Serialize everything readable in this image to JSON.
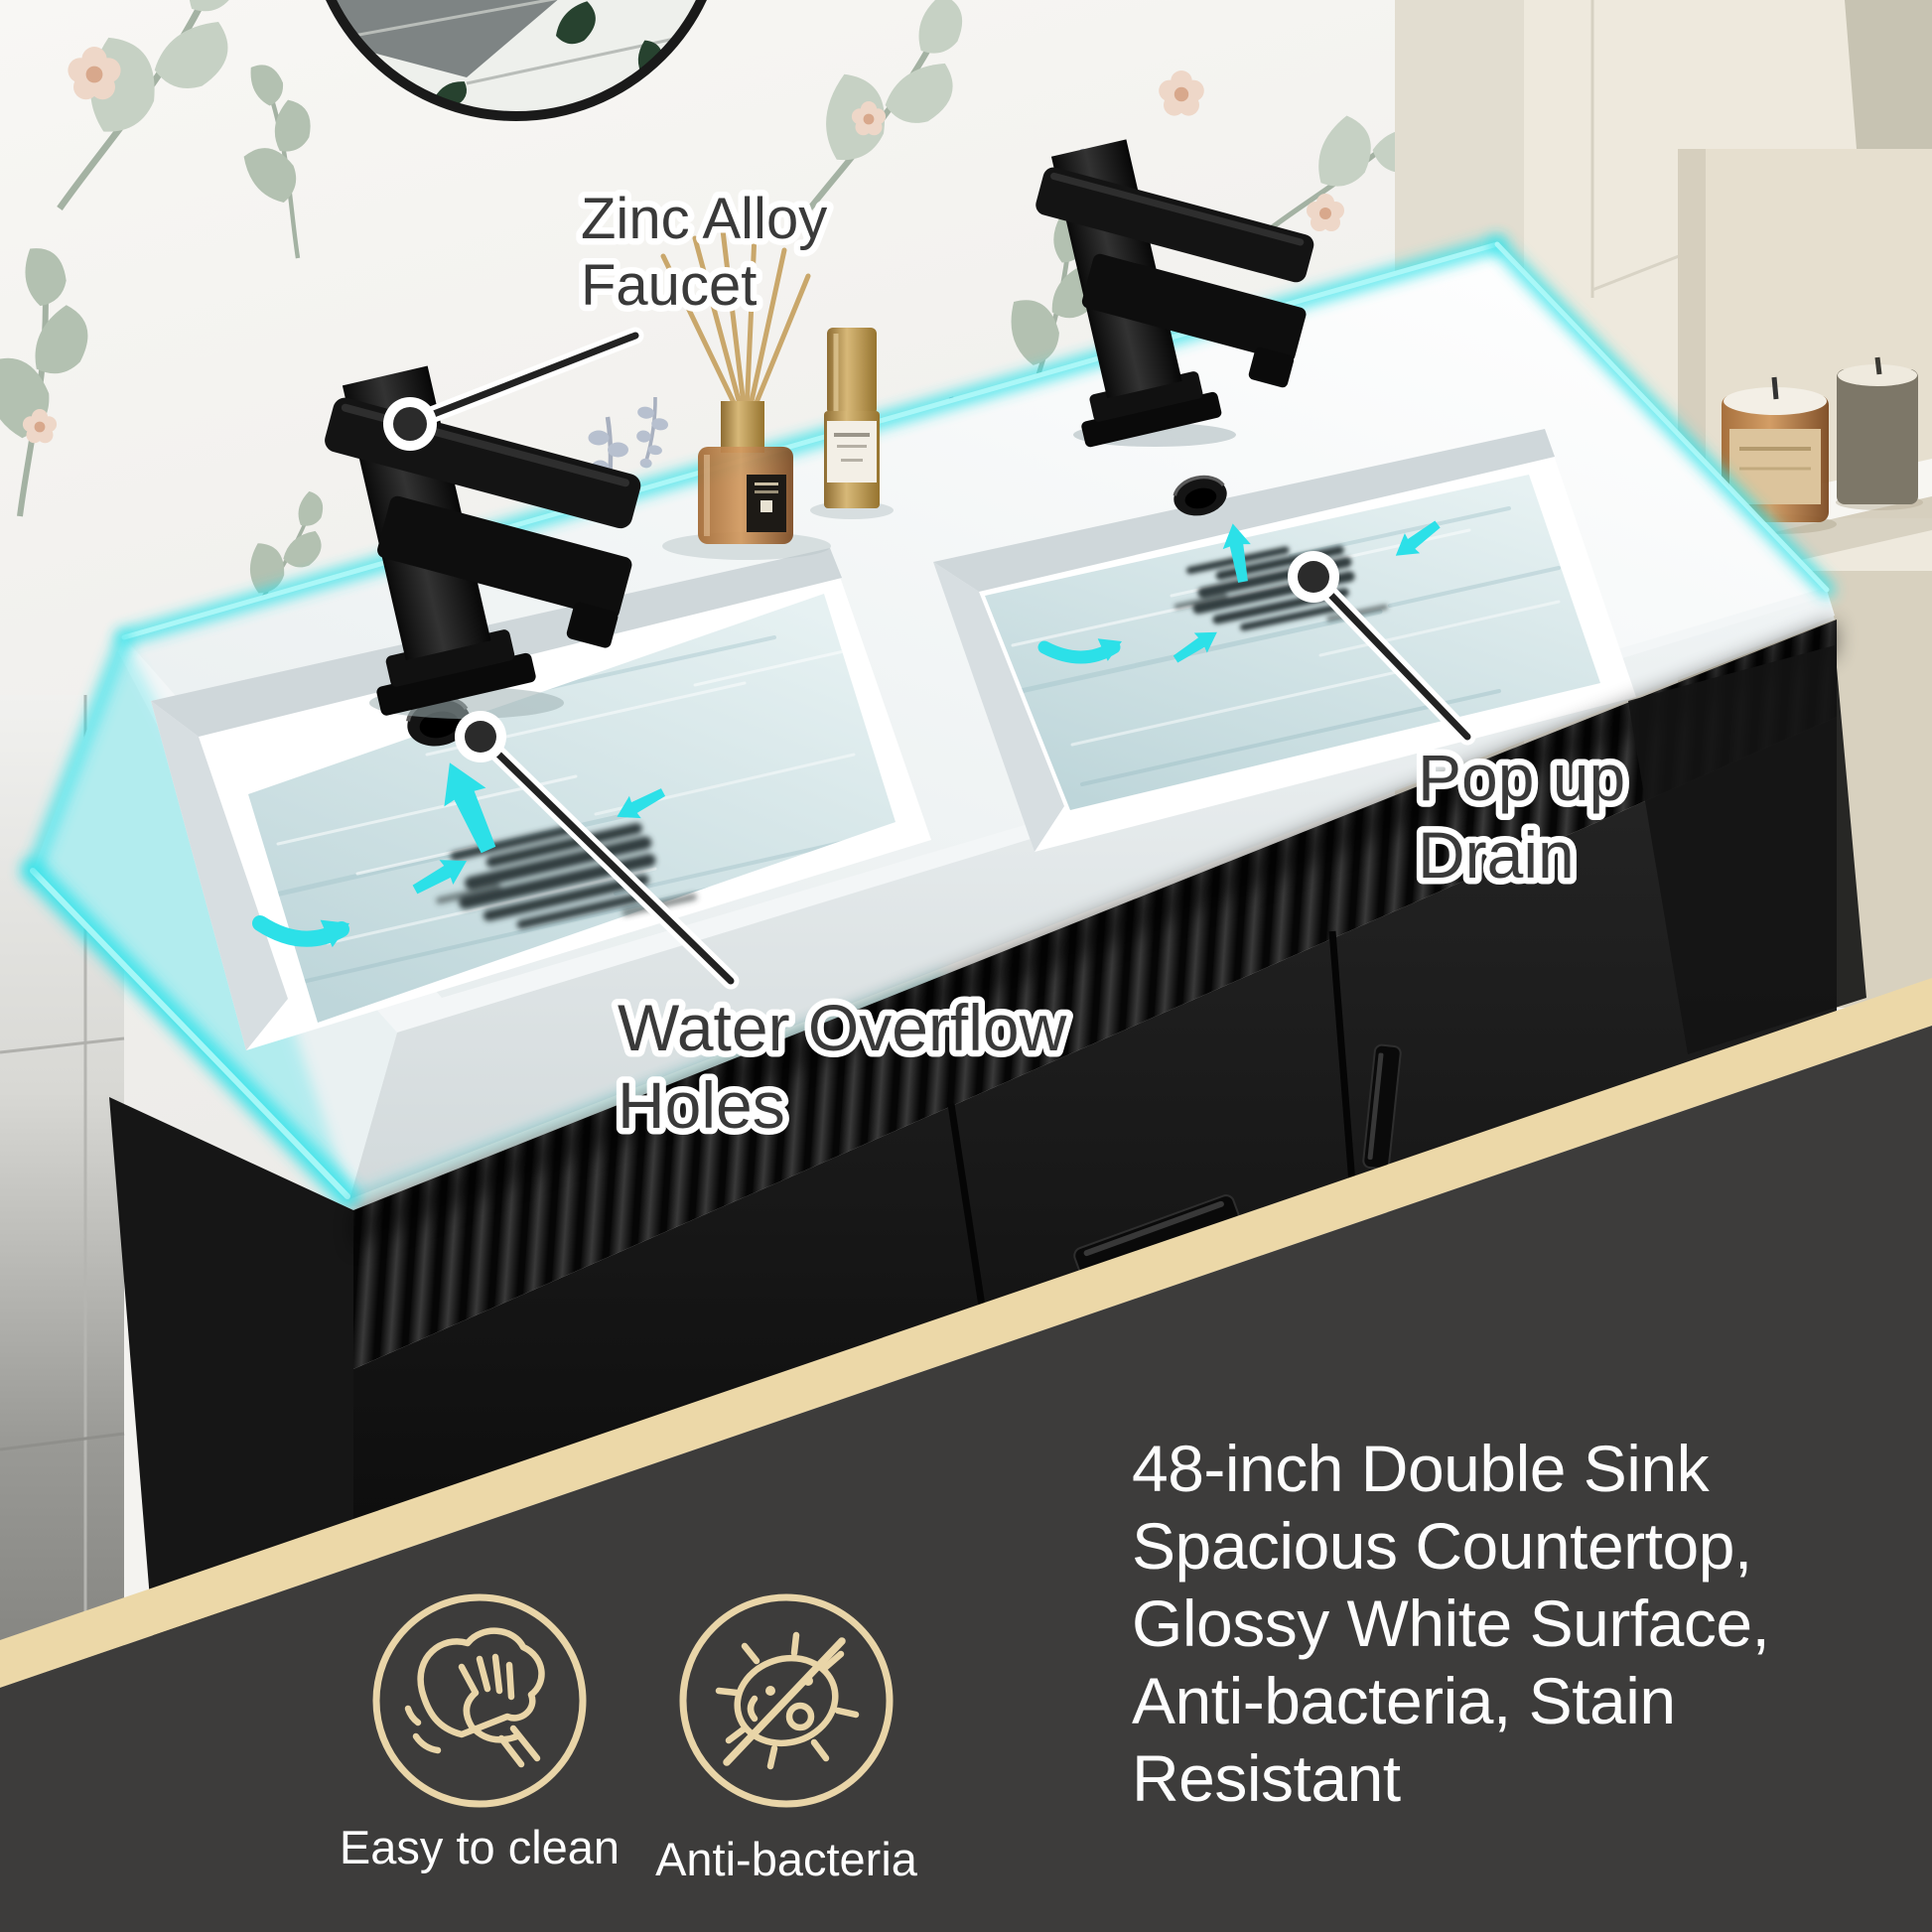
{
  "page": {
    "type": "product-infographic",
    "subject": "48-inch double sink black bathroom vanity with white countertop"
  },
  "callouts": {
    "faucet": {
      "lines": [
        "Zinc Alloy",
        "Faucet"
      ]
    },
    "overflow": {
      "lines": [
        "Water Overflow",
        "Holes"
      ]
    },
    "drain": {
      "lines": [
        "Pop up",
        "Drain"
      ]
    }
  },
  "features": {
    "lines": [
      "48-inch Double Sink",
      "Spacious Countertop,",
      "Glossy White Surface,",
      "Anti-bacteria, Stain",
      "Resistant"
    ]
  },
  "badges": [
    {
      "icon": "wipe-clean-icon",
      "label": "Easy to clean"
    },
    {
      "icon": "no-bacteria-icon",
      "label": "Anti-bacteria"
    }
  ],
  "colors": {
    "accent_cyan": "#35E1E8",
    "band_tan": "#ECD8A8",
    "panel_gray": "#3D3C3B",
    "icon_gold": "#E9D5A8",
    "callout_text": "#3A3A3A",
    "feature_text": "#FFFFFF"
  }
}
